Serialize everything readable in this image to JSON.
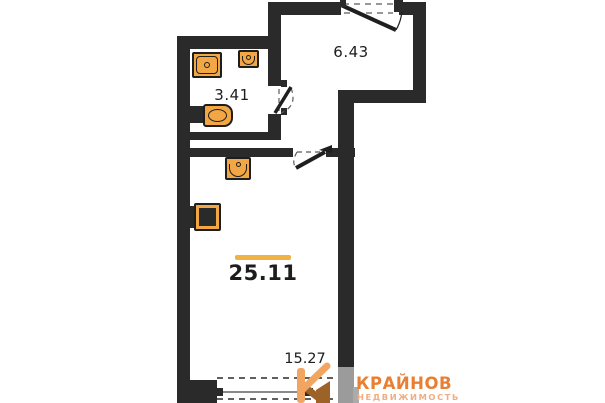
{
  "plan": {
    "type": "apartment-floor-plan",
    "total_area": {
      "value": "25.11"
    },
    "rooms": [
      {
        "name": "bathroom",
        "area": "3.41"
      },
      {
        "name": "hallway",
        "area": "6.43"
      },
      {
        "name": "living-room",
        "area": "15.27"
      }
    ],
    "fixtures": [
      {
        "name": "shower-tray"
      },
      {
        "name": "bathroom-sink"
      },
      {
        "name": "toilet"
      },
      {
        "name": "kitchen-sink"
      },
      {
        "name": "stove"
      }
    ],
    "doors": [
      {
        "name": "entrance-door"
      },
      {
        "name": "bathroom-door"
      },
      {
        "name": "room-door"
      }
    ],
    "colors": {
      "wall": "#2a2a2a",
      "fixture_fill": "#f2a644",
      "area_marker": "#f0b145",
      "text": "#1d1d1d"
    }
  },
  "logo": {
    "brand": "КРАЙНОВ",
    "tagline": "НЕДВИЖИМОСТЬ",
    "brand_color": "#e87f33",
    "tagline_color": "#f1ac83",
    "icon": "house-k-icon"
  }
}
